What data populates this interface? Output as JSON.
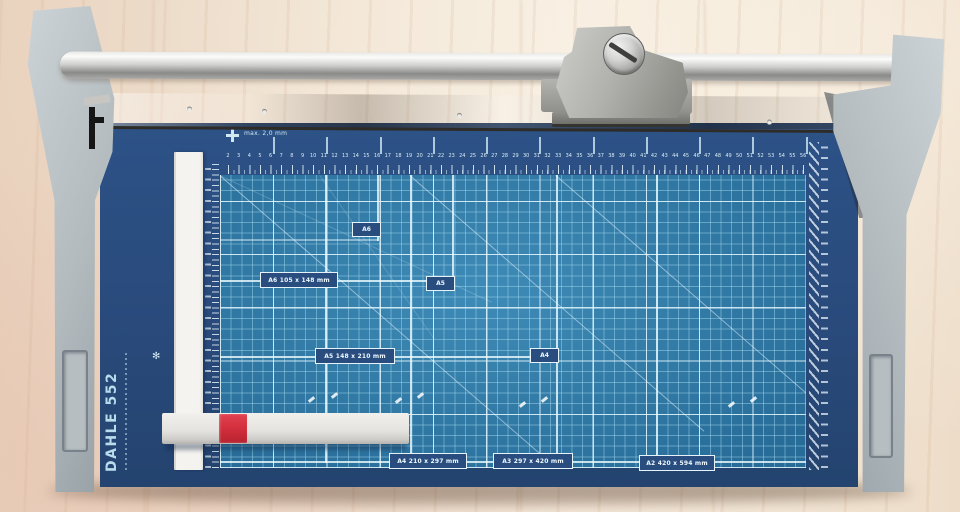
{
  "scene": {
    "subject": "Rotary paper trimmer with blue A-size cutting grid on a light wooden desk"
  },
  "branding": {
    "vertical_label": "DAHLE 552",
    "logo_mark": "✻"
  },
  "trimmer": {
    "capacity_label": "max. 2,0 mm",
    "mat": {
      "corner_tags": [
        {
          "text": "A6"
        },
        {
          "text": "A5"
        },
        {
          "text": "A4"
        }
      ],
      "size_labels": [
        {
          "text": "A6  105 x 148 mm"
        },
        {
          "text": "A5  148 x 210 mm"
        },
        {
          "text": "A4  210 x 297 mm"
        },
        {
          "text": "A3  297 x 420 mm"
        },
        {
          "text": "A2  420 x 594 mm"
        }
      ],
      "top_ruler": {
        "start": 2,
        "end": 56,
        "unit": "cm"
      }
    }
  },
  "colors": {
    "mat_navy": "#294a7b",
    "grid_blue": "#2f7cab",
    "grid_line": "#e8f9fe",
    "red_button": "#d5303e",
    "support_gray": "#b4bcc0",
    "steel_rail": "#988f81",
    "chrome_bar": "#cfcfcd",
    "wood": "#f0e2d1",
    "ruler_strip_white": "#f4f3ef"
  }
}
